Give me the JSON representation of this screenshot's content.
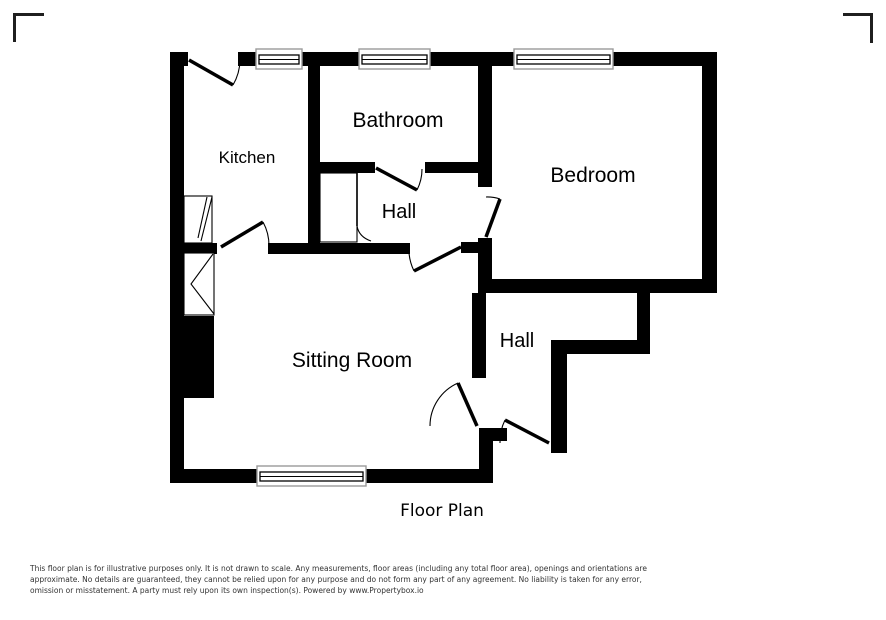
{
  "floor_plan": {
    "caption": "Floor Plan",
    "rooms": [
      {
        "label": "Kitchen"
      },
      {
        "label": "Bathroom"
      },
      {
        "label": "Bedroom"
      },
      {
        "label": "Hall"
      },
      {
        "label": "Sitting Room"
      },
      {
        "label": "Hall"
      }
    ],
    "features": {
      "windows": 4,
      "doors": 7,
      "cupboards": 3
    },
    "colors": {
      "wall": "#000000",
      "window_frame": "#9a9a9a",
      "background": "#ffffff",
      "corner_mark": "#1f1f1f",
      "disclaimer_text": "#333333"
    }
  },
  "disclaimer": {
    "line1": "This floor plan is for illustrative purposes only. It is not drawn to scale. Any measurements, floor areas (including any total floor area), openings and orientations are",
    "line2": "approximate. No details are guaranteed, they cannot be relied upon for any purpose and do not form any part of any agreement. No liability is taken for any error,",
    "line3": "omission or misstatement. A party must rely upon its own inspection(s). Powered by www.Propertybox.io"
  }
}
